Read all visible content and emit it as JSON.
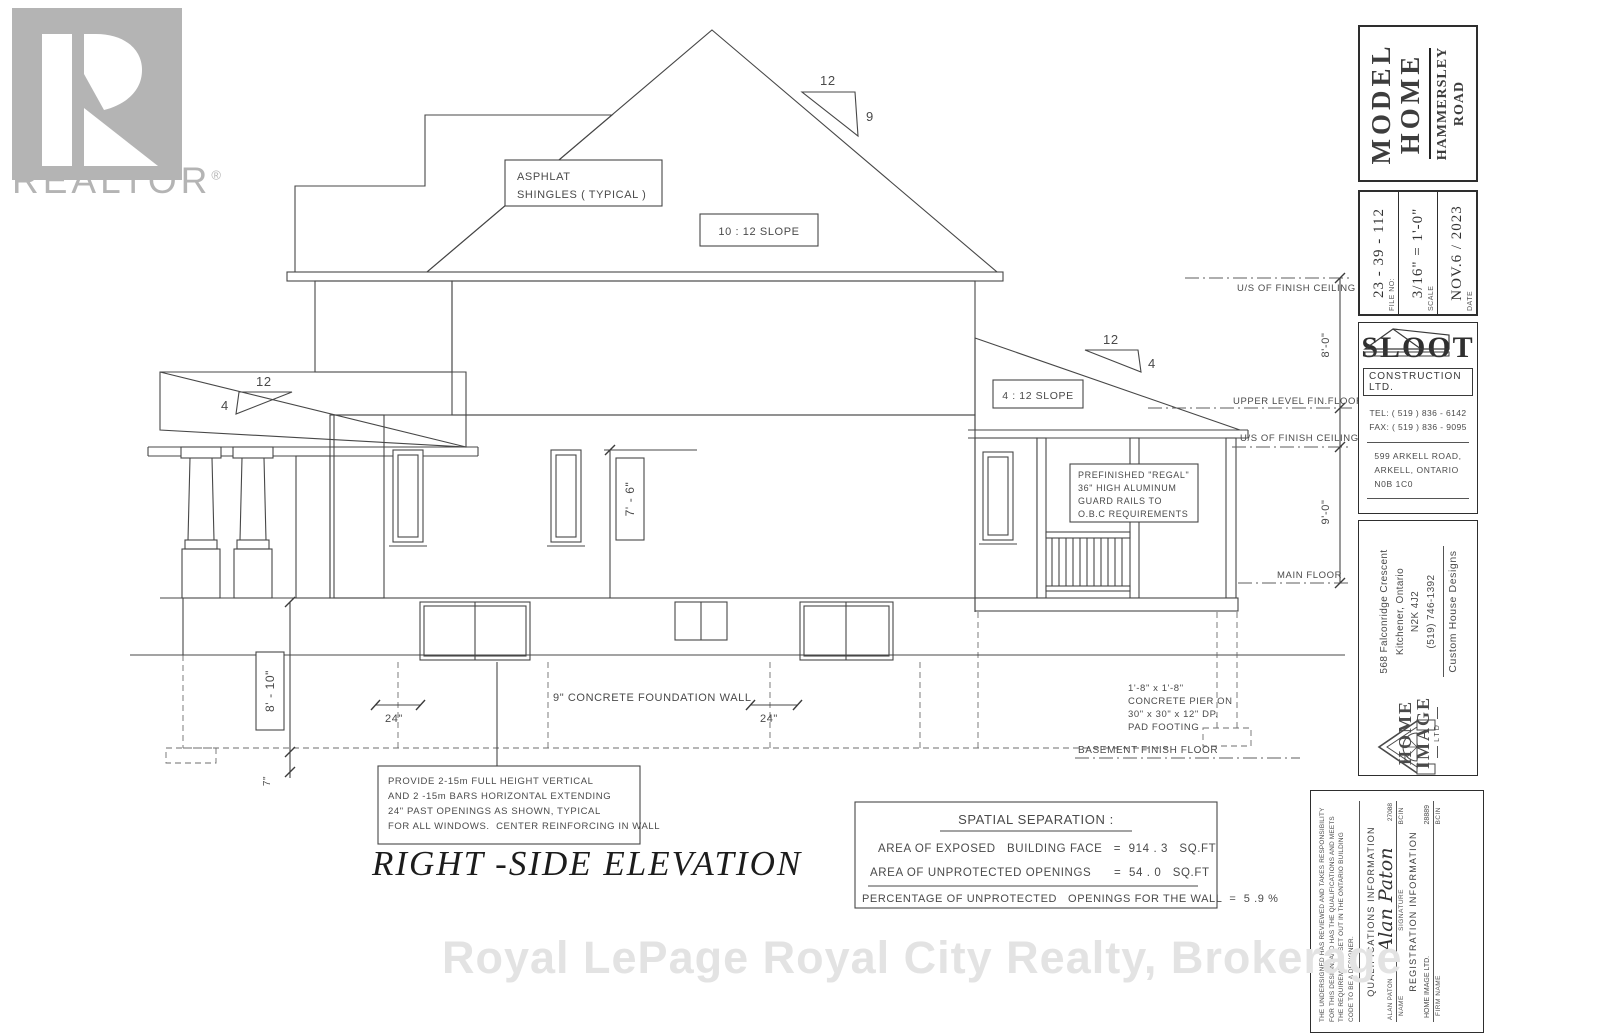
{
  "branding": {
    "realtor_word": "REALTOR",
    "registered": "®",
    "watermark": "Royal LePage Royal City Realty, Brokerage"
  },
  "drawing": {
    "title": "RIGHT  -SIDE ELEVATION",
    "labels": {
      "shingles_line1": "ASPHLAT",
      "shingles_line2": "SHINGLES ( TYPICAL )",
      "slope_main": "10 : 12 SLOPE",
      "slope_low": "4 : 12 SLOPE",
      "twelve": "12",
      "nine": "9",
      "four": "4",
      "us_finish_ceiling": "U/S OF FINISH CEILING",
      "dim_8_0": "8'-0\"",
      "upper_level_fin_floor": "UPPER LEVEL FIN.FLOOR",
      "dim_9_0": "9'-0\"",
      "main_floor": "MAIN FLOOR",
      "dim_7_6": "7' - 6\"",
      "dim_8_10": "8' - 10\"",
      "dim_7in": "7\"",
      "dim_24": "24\"",
      "foundation_wall": "9\" CONCRETE FOUNDATION WALL",
      "basement_finish_floor": "BASEMENT FINISH FLOOR"
    },
    "guard_note": [
      "PREFINISHED \"REGAL\"",
      "36\" HIGH ALUMINUM",
      "GUARD RAILS TO",
      "O.B.C REQUIREMENTS"
    ],
    "pier_note": [
      "1'-8\" x 1'-8\"",
      "CONCRETE PIER ON",
      "30\" x 30\" x 12\" DP.",
      "PAD FOOTING"
    ],
    "rebar_note": [
      "PROVIDE 2-15m FULL HEIGHT VERTICAL",
      "AND 2 -15m BARS HORIZONTAL EXTENDING",
      "24\" PAST OPENINGS AS SHOWN, TYPICAL",
      "FOR ALL WINDOWS.  CENTER REINFORCING IN WALL"
    ],
    "spatial": {
      "title": "SPATIAL SEPARATION :",
      "row1": "AREA OF EXPOSED   BUILDING FACE   =  914 . 3   SQ.FT",
      "row2": "AREA OF UNPROTECTED OPENINGS      =  54 . 0   SQ.FT",
      "row3": "PERCENTAGE OF UNPROTECTED   OPENINGS FOR THE WALL  =  5 .9 %"
    }
  },
  "title_block": {
    "project": {
      "line1": "MODEL",
      "line2": "HOME",
      "sub1": "HAMMERSLEY",
      "sub2": "ROAD"
    },
    "file_no": {
      "label": "FILE NO:",
      "value": "23 - 39 - 112"
    },
    "scale": {
      "label": "SCALE",
      "value": "3/16\" = 1'-0\""
    },
    "date": {
      "label": "DATE",
      "value": "NOV.6 / 2023"
    },
    "builder": {
      "name": "SLOOT",
      "type": "CONSTRUCTION LTD.",
      "tel": "TEL: ( 519 ) 836 - 6142",
      "fax": "FAX: ( 519 ) 836 - 9095",
      "address": [
        "599 ARKELL ROAD,",
        "ARKELL,  ONTARIO",
        "N0B  1C0"
      ]
    },
    "designer": {
      "address": [
        "568 Falconridge Crescent",
        "Kitchener, Ontario",
        "N2K 4J2",
        "(519) 746-1392"
      ],
      "tagline": "Custom House Designs",
      "logo_word1": "HOME",
      "logo_word2": "IMAGE",
      "logo_ltd": "LTD"
    },
    "qualifications": {
      "disclaimer": [
        "THE UNDERSIGNED HAS REVIEWED AND TAKES RESPONSIBILITY",
        "FOR THIS DESIGN,  AND HAS THE QUALIFICATIONS AND MEETS",
        "THE REQUIREMENTS SET OUT IN THE ONTARIO BUILDING",
        "CODE TO BE A DESIGNER."
      ],
      "heading": "QUALIFICATIONS INFORMATION",
      "name_value": "ALAN PATON",
      "signature_script": "Alan Paton",
      "bcin_value": "27088",
      "name_label": "NAME",
      "signature_label": "SIGNATURE",
      "bcin_label": "BCIN",
      "registration_heading": "REGISTRATION INFORMATION",
      "firm_value": "HOME IMAGE LTD.",
      "firm_bcin_value": "28889",
      "firm_label": "FIRM NAME",
      "firm_bcin_label": "BCIN"
    }
  }
}
